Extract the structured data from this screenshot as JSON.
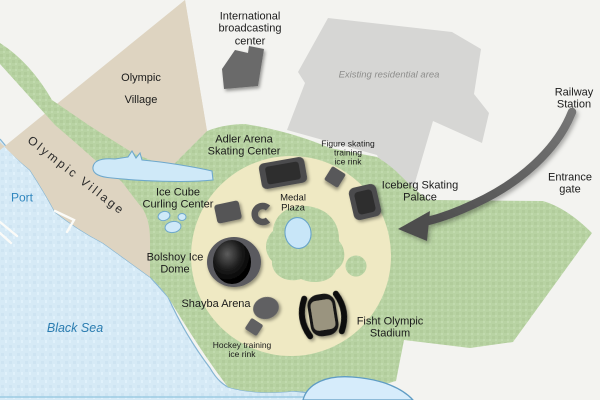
{
  "map_title": "Sochi Olympic Park map",
  "labels": {
    "ibc": "International\nbroadcasting\ncenter",
    "olympic_village_area": "Olympic\nVillage",
    "olympic_village_coast": "Olympic Village",
    "port": "Port",
    "residential": "Existing residential area",
    "railway": "Railway\nStation",
    "entrance": "Entrance\ngate",
    "adler": "Adler Arena\nSkating Center",
    "figure": "Figure skating\ntraining\nice rink",
    "iceberg": "Iceberg Skating\nPalace",
    "ice_cube": "Ice Cube\nCurling Center",
    "medal": "Medal\nPlaza",
    "bolshoy": "Bolshoy Ice\nDome",
    "shayba": "Shayba Arena",
    "fisht": "Fisht Olympic\nStadium",
    "hockey": "Hockey training\nice rink",
    "black_sea": "Black Sea"
  },
  "palette": {
    "background": "#f3f3f0",
    "sea": "#d6eaf6",
    "pond": "#cfe9f8",
    "shore_stroke": "#85b5d3",
    "park_green": "#b8d3a3",
    "plaza_cream": "#efe9c3",
    "coast_beige": "#ded4c1",
    "residential_gray": "#d6d6d4",
    "building_gray": "#6a6a6a",
    "venue_dark": "#4b4b4d",
    "venue_inner": "#2d2d2f",
    "arrow_gray": "#4e4e4e",
    "label_text": "#1b1b1b",
    "water_label_blue": "#2f86be"
  }
}
